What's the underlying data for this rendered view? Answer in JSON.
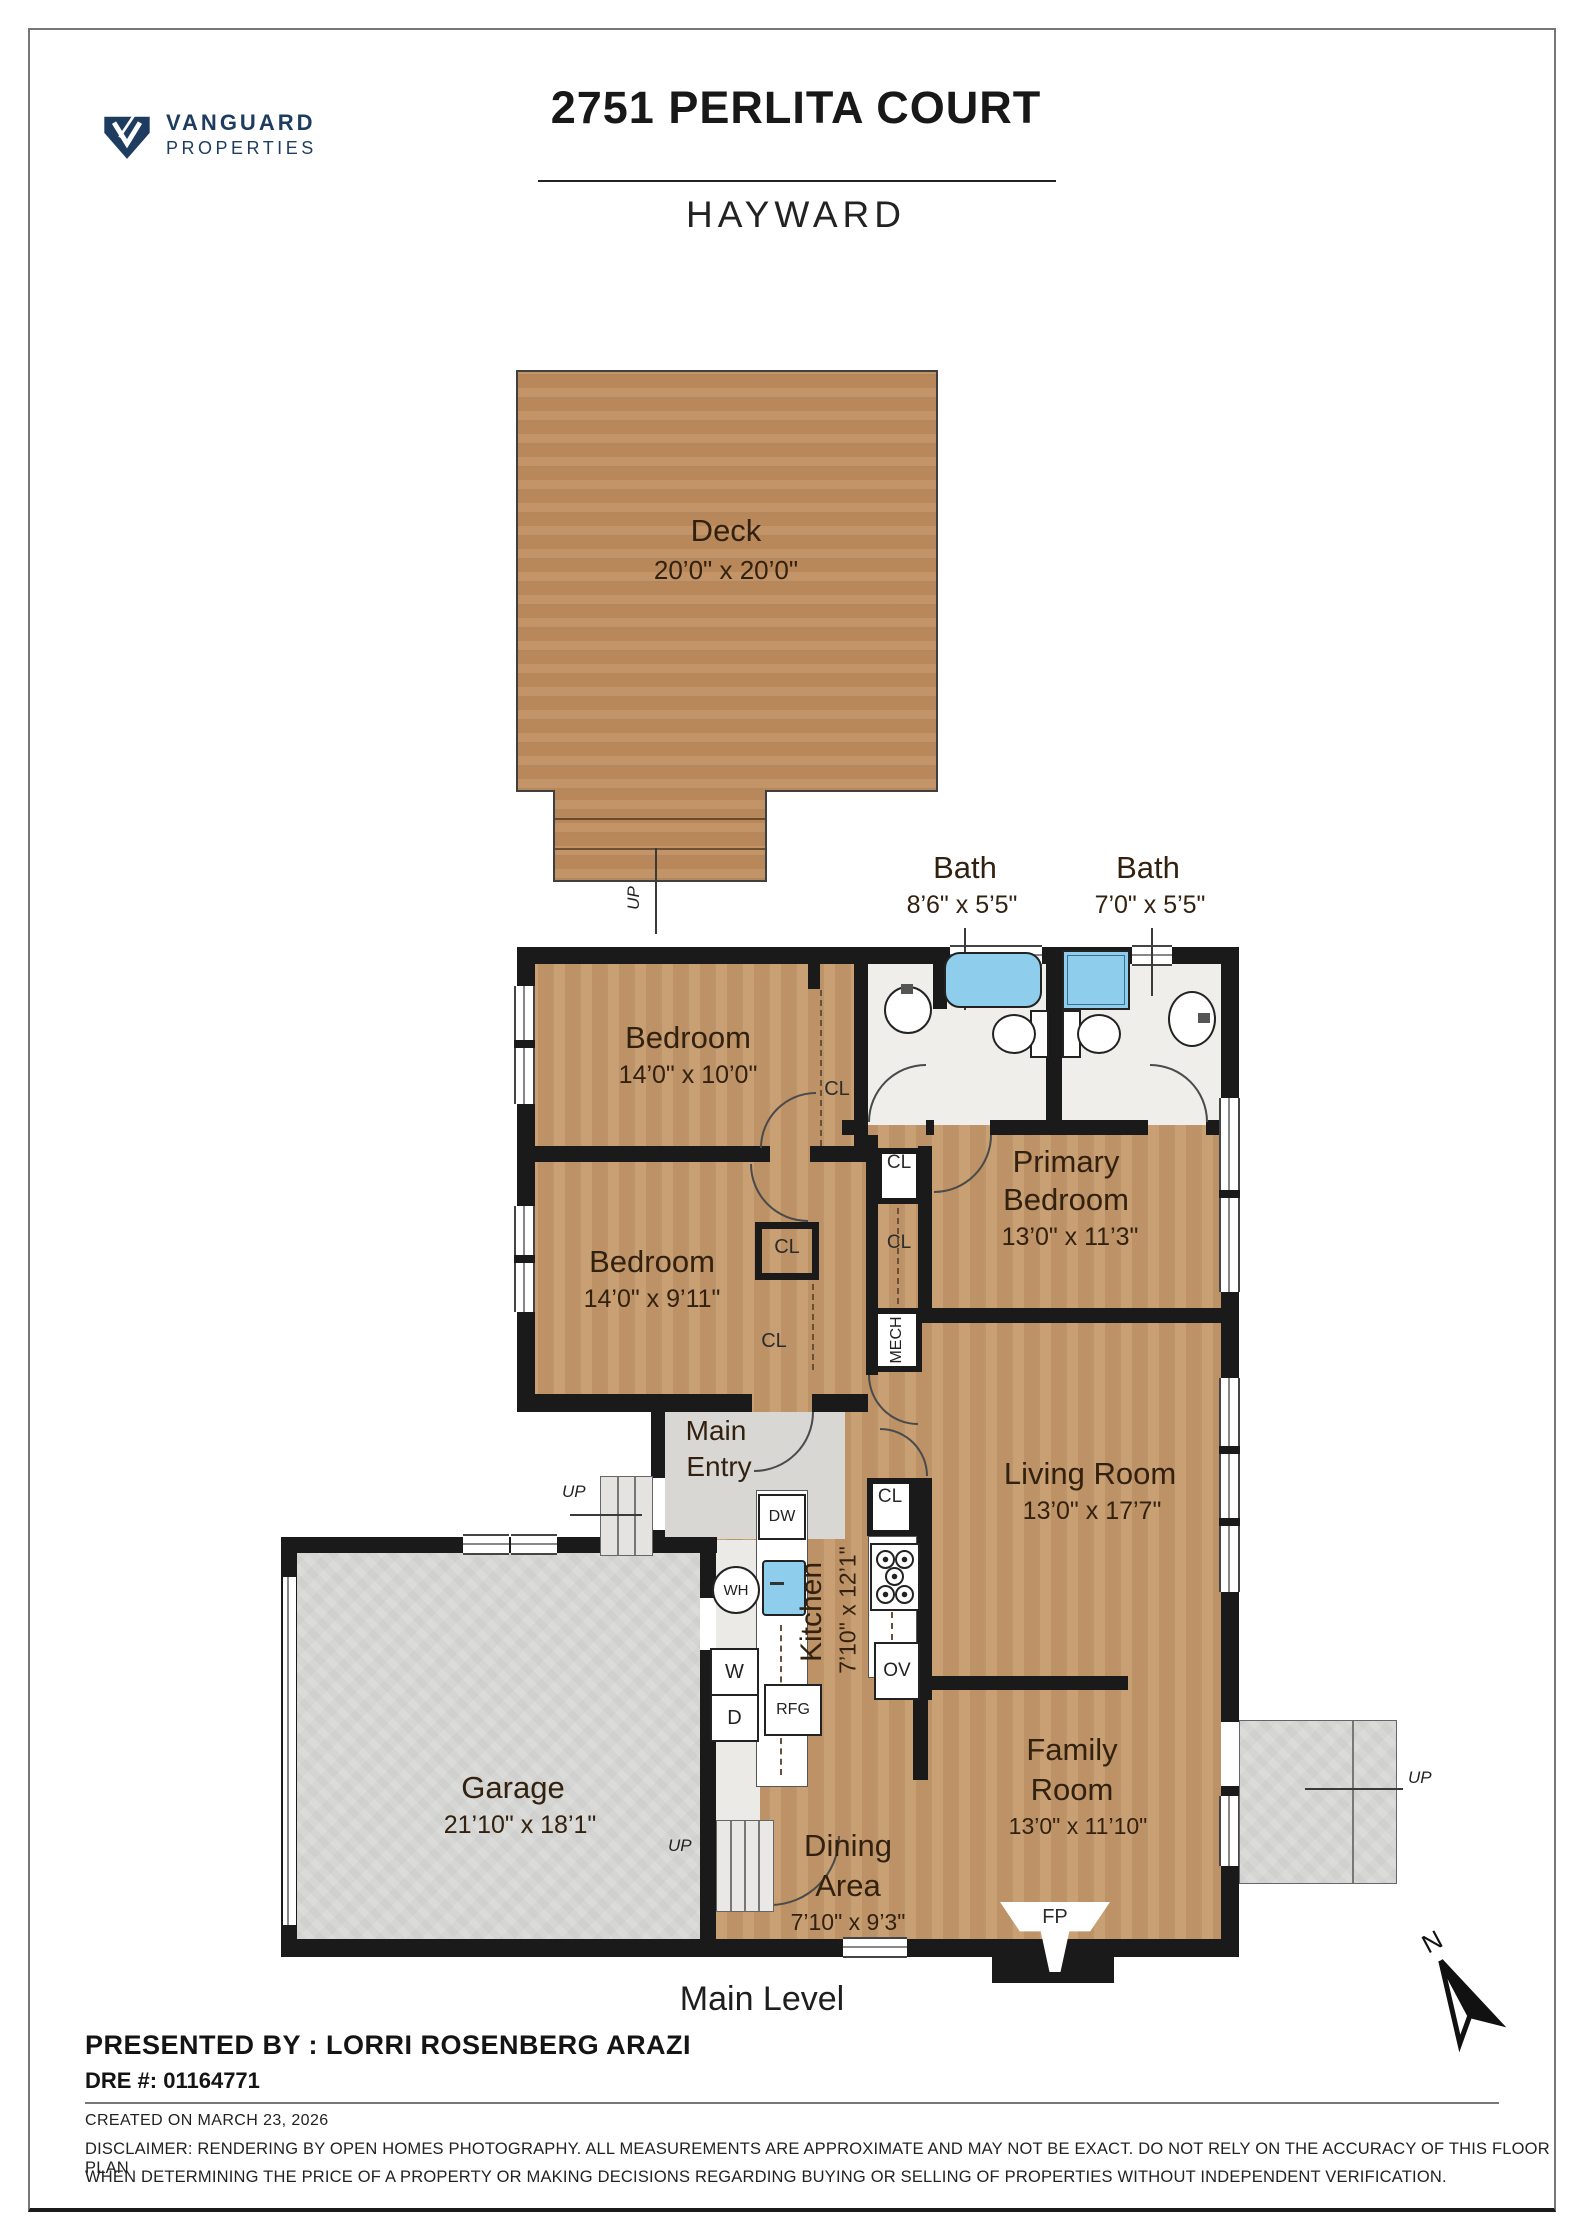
{
  "header": {
    "brand_line1": "VANGUARD",
    "brand_line2": "PROPERTIES",
    "title": "2751 PERLITA COURT",
    "subtitle": "HAYWARD"
  },
  "plan": {
    "level_label": "Main Level",
    "compass_north": "N",
    "rooms": {
      "deck": {
        "name": "Deck",
        "dims": "20’0\" x 20’0\""
      },
      "bath1": {
        "name": "Bath",
        "dims": "8’6\" x 5’5\""
      },
      "bath2": {
        "name": "Bath",
        "dims": "7’0\" x 5’5\""
      },
      "bedroom1": {
        "name": "Bedroom",
        "dims": "14’0\" x 10’0\""
      },
      "bedroom2": {
        "name": "Bedroom",
        "dims": "14’0\" x 9’11\""
      },
      "primary": {
        "name_line1": "Primary",
        "name_line2": "Bedroom",
        "dims": "13’0\" x 11’3\""
      },
      "living": {
        "name": "Living Room",
        "dims": "13’0\" x 17’7\""
      },
      "kitchen": {
        "name": "Kitchen",
        "dims": "7’10\" x 12’1\""
      },
      "garage": {
        "name": "Garage",
        "dims": "21’10\" x 18’1\""
      },
      "dining": {
        "name_line1": "Dining",
        "name_line2": "Area",
        "dims": "7’10\" x 9’3\""
      },
      "family": {
        "name_line1": "Family",
        "name_line2": "Room",
        "dims": "13’0\" x 11’10\""
      },
      "entry": {
        "name_line1": "Main",
        "name_line2": "Entry"
      }
    },
    "tags": {
      "cl": "CL",
      "mech": "MECH",
      "dw": "DW",
      "wh": "WH",
      "w": "W",
      "d": "D",
      "rfg": "RFG",
      "ov": "OV",
      "fp": "FP",
      "up": "UP"
    }
  },
  "footer": {
    "presented_by": "PRESENTED BY : LORRI ROSENBERG ARAZI",
    "dre": "DRE #: 01164771",
    "created": "CREATED ON MARCH 23, 2026",
    "disclaimer_line1": "DISCLAIMER: RENDERING BY OPEN HOMES PHOTOGRAPHY. ALL MEASUREMENTS ARE APPROXIMATE AND MAY NOT BE EXACT. DO NOT RELY ON THE ACCURACY OF THIS FLOOR PLAN",
    "disclaimer_line2": "WHEN DETERMINING THE PRICE OF A PROPERTY OR MAKING DECISIONS REGARDING BUYING OR SELLING OF PROPERTIES WITHOUT INDEPENDENT VERIFICATION."
  },
  "colors": {
    "brand_navy": "#1d3c5f",
    "wall_black": "#1a1a1a",
    "fixture_blue": "#8fcdec",
    "wood": "#c69a6b",
    "deck_wood": "#c08e5f",
    "concrete": "#d9d9d7",
    "bath_tile": "#efeeeb"
  }
}
